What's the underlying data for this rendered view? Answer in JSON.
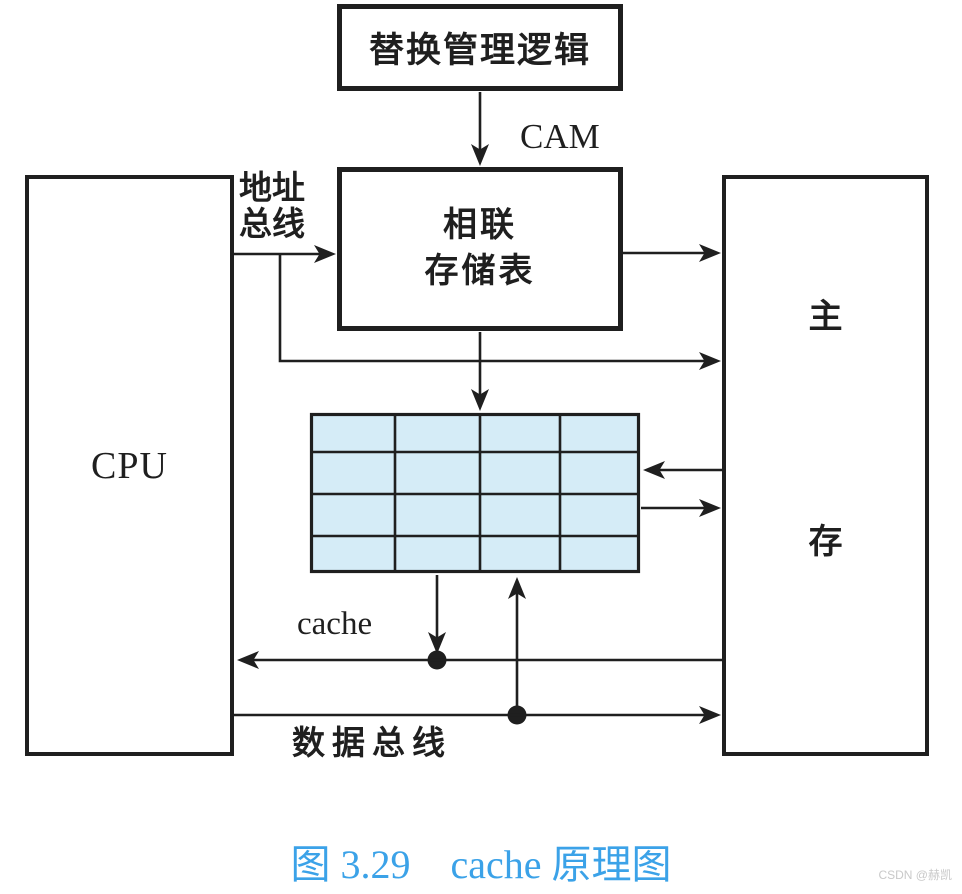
{
  "diagram": {
    "boxes": {
      "replacement_logic": {
        "label": "替换管理逻辑"
      },
      "associative_table": {
        "line1": "相联",
        "line2": "存储表"
      },
      "cpu": {
        "label": "CPU"
      },
      "main_memory": {
        "char1": "主",
        "char2": "存"
      }
    },
    "labels": {
      "cam": "CAM",
      "address_bus_line1": "地址",
      "address_bus_line2": "总线",
      "cache": "cache",
      "data_bus": "数据总线"
    },
    "cache_grid": {
      "rows": 4,
      "cols": 4
    }
  },
  "caption": {
    "text": "图 3.29　cache 原理图"
  },
  "watermark": {
    "text": "CSDN @赫凯"
  },
  "colors": {
    "line": "#1f1f1f",
    "grid_fill": "#d5ecf7",
    "caption_blue": "#3ba2e8",
    "watermark_gray": "#c9c9c9"
  }
}
